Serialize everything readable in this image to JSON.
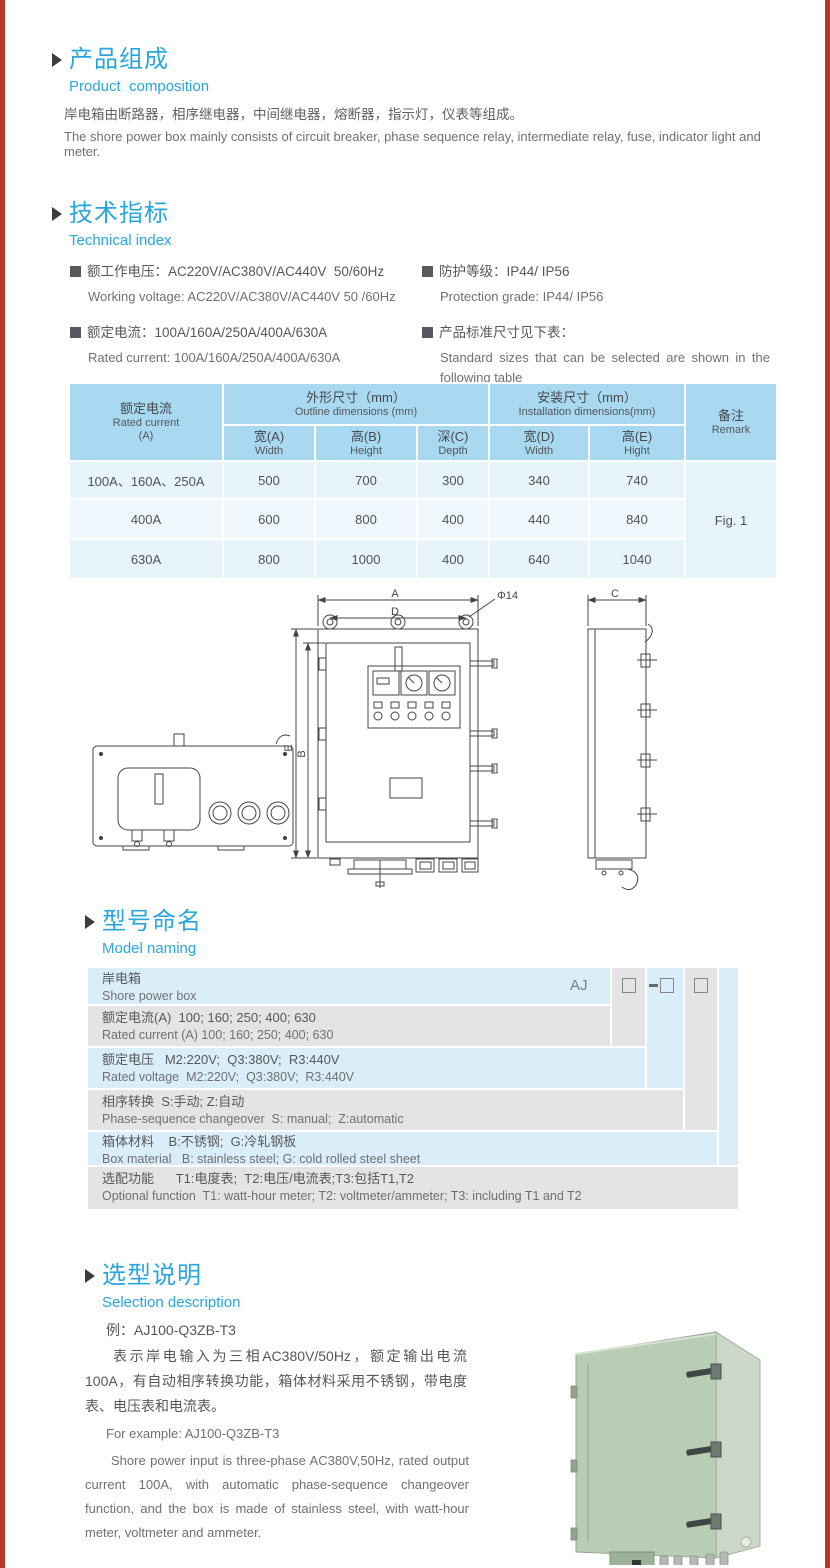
{
  "page": {
    "edge_color": "#b5392f"
  },
  "composition": {
    "title_cn": "产品组成",
    "title_en": "Product  composition",
    "desc_cn": "岸电箱由断路器，相序继电器，中间继电器，熔断器，指示灯，仪表等组成。",
    "desc_en": "The shore power box mainly consists of circuit breaker, phase sequence relay, intermediate relay, fuse, indicator light and meter."
  },
  "technical": {
    "title_cn": "技术指标",
    "title_en": "Technical index",
    "specs": [
      {
        "cn": "额工作电压：AC220V/AC380V/AC440V  50/60Hz",
        "en": "Working voltage: AC220V/AC380V/AC440V 50 /60Hz"
      },
      {
        "cn": "额定电流：100A/160A/250A/400A/630A",
        "en": "Rated current: 100A/160A/250A/400A/630A"
      },
      {
        "cn": "防护等级：IP44/ IP56",
        "en": "Protection grade: IP44/ IP56"
      },
      {
        "cn": "产品标准尺寸见下表：",
        "en": "Standard sizes that can be selected are shown in the following table"
      }
    ]
  },
  "size_table": {
    "header": {
      "rated_cn": "额定电流",
      "rated_en": "Rated current",
      "rated_unit": "(A)",
      "outline_cn": "外形尺寸（mm）",
      "outline_en": "Outline dimensions (mm)",
      "install_cn": "安装尺寸（mm）",
      "install_en": "Installation dimensions(mm)",
      "remark_cn": "备注",
      "remark_en": "Remark",
      "cols": [
        {
          "cn": "宽(A)",
          "en": "Width"
        },
        {
          "cn": "高(B)",
          "en": "Height"
        },
        {
          "cn": "深(C)",
          "en": "Depth"
        },
        {
          "cn": "宽(D)",
          "en": "Width"
        },
        {
          "cn": "高(E)",
          "en": "Hight"
        }
      ]
    },
    "rows": [
      {
        "current": "100A、160A、250A",
        "values": [
          "500",
          "700",
          "300",
          "340",
          "740"
        ]
      },
      {
        "current": "400A",
        "values": [
          "600",
          "800",
          "400",
          "440",
          "840"
        ]
      },
      {
        "current": "630A",
        "values": [
          "800",
          "1000",
          "400",
          "640",
          "1040"
        ]
      }
    ],
    "remark_value": "Fig. 1"
  },
  "drawing": {
    "dim_a": "A",
    "dim_d": "D",
    "hole": "Φ14",
    "dim_e": "E",
    "dim_b": "B",
    "dim_c": "C"
  },
  "naming": {
    "title_cn": "型号命名",
    "title_en": "Model naming",
    "prefix": "AJ",
    "rows": [
      {
        "cn": "岸电箱",
        "en": "Shore power box"
      },
      {
        "cn": "额定电流(A)  100; 160; 250; 400; 630",
        "en": "Rated current (A) 100; 160; 250; 400; 630"
      },
      {
        "cn": "额定电压   M2:220V;  Q3:380V;  R3:440V",
        "en": "Rated voltage  M2:220V;  Q3:380V;  R3:440V"
      },
      {
        "cn": "相序转换  S:手动; Z:自动",
        "en": "Phase-sequence changeover  S: manual;  Z:automatic"
      },
      {
        "cn": "箱体材料    B:不锈钢;  G:冷轧钢板",
        "en": "Box material   B: stainless steel; G: cold rolled steel sheet"
      },
      {
        "cn": "选配功能      T1:电度表;  T2:电压/电流表;T3:包括T1,T2",
        "en": "Optional function  T1: watt-hour meter; T2: voltmeter/ammeter; T3: including T1 and T2"
      }
    ]
  },
  "selection": {
    "title_cn": "选型说明",
    "title_en": "Selection description",
    "example_cn": "例：AJ100-Q3ZB-T3",
    "desc_cn": "表示岸电输入为三相AC380V/50Hz，额定输出电流100A，有自动相序转换功能，箱体材料采用不锈钢，带电度表、电压表和电流表。",
    "example_en": "For example: AJ100-Q3ZB-T3",
    "desc_en": "Shore power input is three-phase AC380V,50Hz, rated output current 100A, with automatic phase-sequence changeover function, and the box is made of stainless steel, with watt-hour meter, voltmeter and ammeter."
  }
}
